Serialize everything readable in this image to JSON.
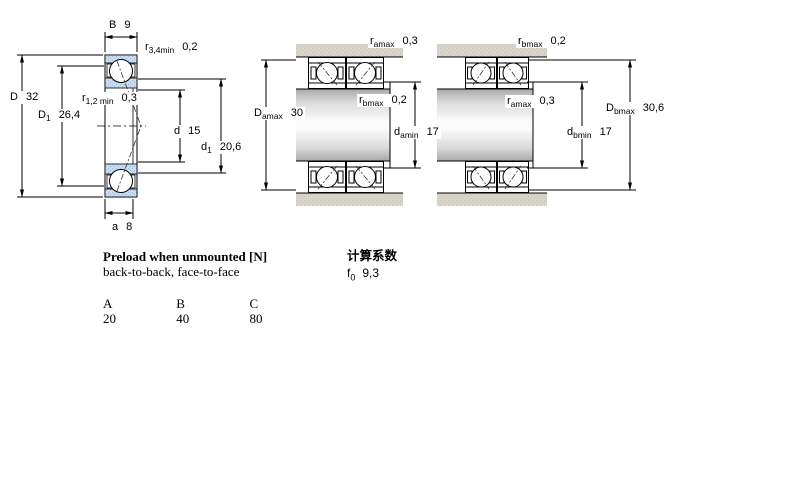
{
  "diagram": {
    "dims": {
      "B": {
        "sym": "B",
        "sub": "",
        "val": "9"
      },
      "r34": {
        "sym": "r",
        "sub": "3,4min",
        "val": "0,2"
      },
      "D": {
        "sym": "D",
        "sub": "",
        "val": "32"
      },
      "D1": {
        "sym": "D",
        "sub": "1",
        "val": "26,4"
      },
      "r12": {
        "sym": "r",
        "sub": "1,2 min",
        "val": "0,3"
      },
      "d": {
        "sym": "d",
        "sub": "",
        "val": "15"
      },
      "d1": {
        "sym": "d",
        "sub": "1",
        "val": "20,6"
      },
      "a": {
        "sym": "a",
        "sub": "",
        "val": "8"
      },
      "ramax": {
        "sym": "r",
        "sub": "amax",
        "val": "0,3"
      },
      "rbmax": {
        "sym": "r",
        "sub": "bmax",
        "val": "0,2"
      },
      "Damax": {
        "sym": "D",
        "sub": "amax",
        "val": "30"
      },
      "damin": {
        "sym": "d",
        "sub": "amin",
        "val": "17"
      },
      "Dbmax": {
        "sym": "D",
        "sub": "bmax",
        "val": "30,6"
      },
      "dbmin": {
        "sym": "d",
        "sub": "bmin",
        "val": "17"
      }
    },
    "colors": {
      "ring_blue": "#cadcee",
      "ring_blue_dot": "#9ab8d6",
      "housing_gray": "#d9d5cc",
      "housing_gray_dot": "#c3bfb3"
    }
  },
  "preload": {
    "title": "Preload when unmounted [N]",
    "subtitle": "back-to-back, face-to-face",
    "columns": [
      "A",
      "B",
      "C"
    ],
    "values": [
      "20",
      "40",
      "80"
    ]
  },
  "calc": {
    "title": "计算系数",
    "factor": {
      "sym": "f",
      "sub": "0",
      "val": "9,3"
    }
  }
}
